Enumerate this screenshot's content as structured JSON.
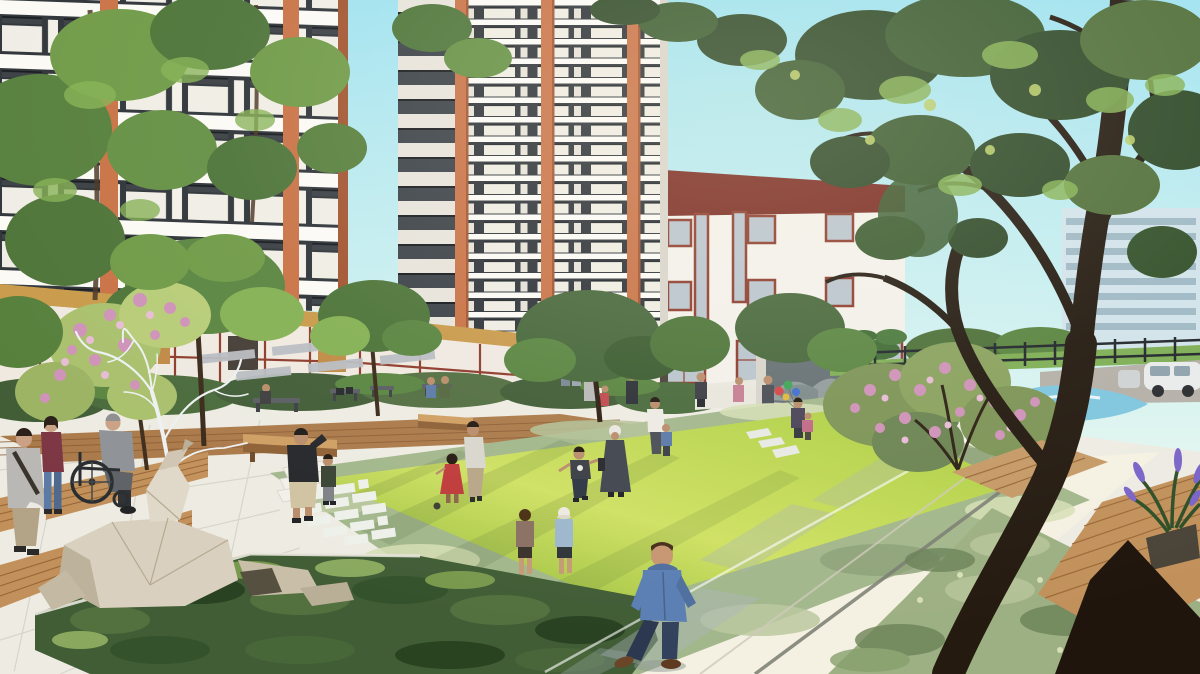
{
  "scene": {
    "type": "architectural-rendering",
    "description": "Sunlit residential courtyard rendering: white apartment towers with terracotta accents, a low community building with a dark-red parapet, a bright central lawn ringed by sage hedges where children play, a stone water-feature wall, wooden boardwalk strips, benches, a low-poly deer sculpture with white wire antlers, a large dark tree framing the right side, and residents strolling - including a wheelchair user, a photographer, a child with balloons and a boy in a blue hoodie."
  },
  "palette": {
    "sky_top": "#9fe2ef",
    "sky_horizon": "#e2f6f0",
    "facade_white": "#f3f0e9",
    "facade_shade": "#ddd8cf",
    "slab_white": "#fbfaf5",
    "glass_dark": "#2e3338",
    "accent_orange": "#c97245",
    "accent_orange_dark": "#a2542f",
    "parapet_red": "#7b2b20",
    "frame_red": "#8e3b2b",
    "distant_building": "#d2e3ea",
    "lawn_main": "#a8cb3f",
    "lawn_light": "#cfe163",
    "lawn_dark": "#8ab335",
    "hedge_sage": "#a3b78c",
    "hedge_sage_light": "#d6dfb6",
    "hedge_dark": "#415d36",
    "foliage_mid": "#5a8540",
    "foliage_light": "#85b153",
    "foliage_dark": "#2f4a28",
    "trunk_dark": "#241a10",
    "path_white": "#edebe2",
    "path_sun": "#f8f3e2",
    "path_shadow": "#a9b3ba",
    "wood_deck": "#c2915b",
    "wood_dark": "#996737",
    "walkway_brown": "#ab7a4a",
    "stone_wall": "#d8d4ca",
    "mural_gray": "#667072",
    "sculpture_beige": "#d9d0bf",
    "wire_white": "#eef1f1",
    "flower_pink": "#cf92b8",
    "flower_purple": "#7a64c8",
    "playground_blue": "#7fc6de",
    "fence_dark": "#22272b",
    "road_gray": "#b5b0a7",
    "van_white": "#e9ebeb",
    "fascia_gold": "#c99a4a",
    "storefront_glow": "#c08a45",
    "grass_strip": "#8fbe4a"
  },
  "people": {
    "foreground_boy": {
      "label": "boy in blue hoodie",
      "hoodie": "#5b7fb3",
      "hood_shade": "#4f6f9e",
      "jeans": "#2c3850",
      "jeans_light": "#33415c",
      "hair": "#46301c",
      "skin": "#c79671",
      "shoes": "#6b4527"
    },
    "photographer": {
      "label": "man taking photo",
      "shirt": "#25272b",
      "shorts": "#cfc3a1",
      "skin": "#b98d6b"
    },
    "wheelchair_user": {
      "label": "elderly man in wheelchair",
      "suit": "#8f9296",
      "trousers": "#5f6266"
    },
    "companion_woman": {
      "label": "woman in maroon top",
      "top": "#7d3744",
      "jeans": "#5b7aa6"
    },
    "bag_man": {
      "label": "man with shoulder bag",
      "top": "#b9b8b4",
      "pants": "#b3a488"
    },
    "red_dress_girl": {
      "label": "girl in red dress",
      "dress": "#bf3a3a"
    },
    "coat_walker": {
      "label": "person in long coat and beanie",
      "coat": "#40454e",
      "beanie": "#e9e7e0"
    },
    "white_shirt_man": {
      "label": "man in white shirt with child",
      "shirt": "#eceae3"
    },
    "running_boy": {
      "label": "running boy",
      "tee": "#3b3e45"
    },
    "hat_kid": {
      "label": "kid with white cap",
      "top": "#9db7cc"
    },
    "brown_kid": {
      "label": "kid in brown top",
      "top": "#8b6f63"
    },
    "balloons": {
      "c0": "#d64545",
      "c1": "#3da456",
      "c2": "#3f6fd0",
      "c3": "#e0b83d"
    }
  },
  "objects": {
    "deer_sculpture": "low-poly lying deer sculpture",
    "wire_tree": "white wireframe antler tree sculpture",
    "water_wall": "stone landscape feature wall",
    "minivan": "white minivan parked beyond fence"
  }
}
